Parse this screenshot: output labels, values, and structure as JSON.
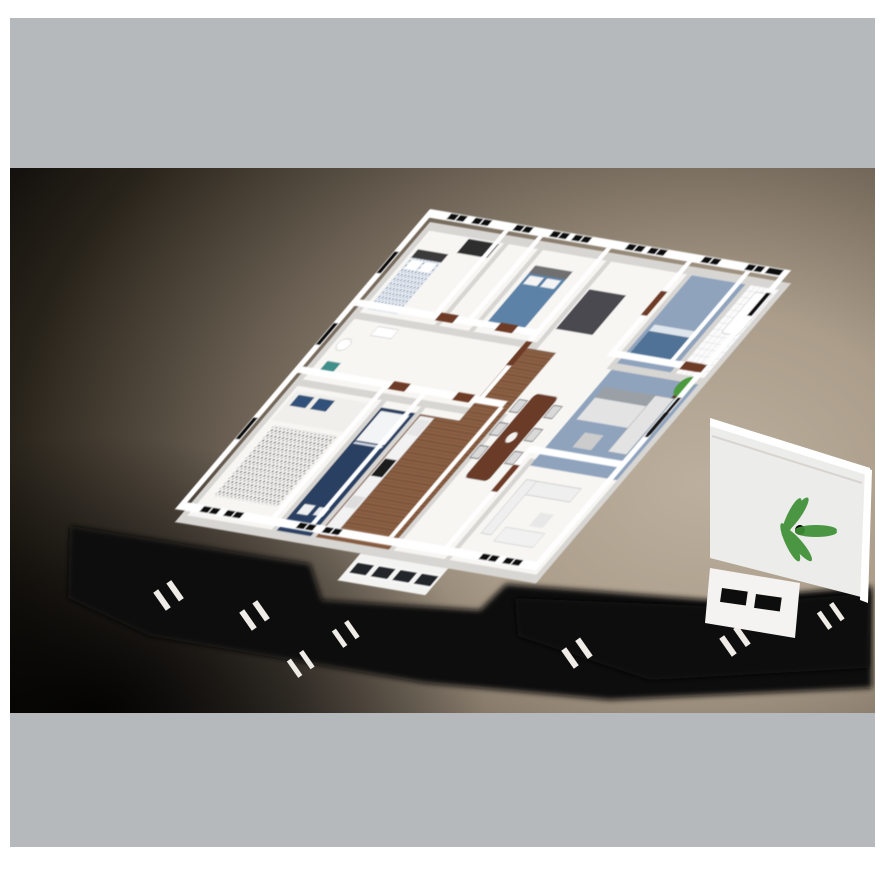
{
  "page": {
    "background": "#ffffff"
  },
  "bands": {
    "top": {
      "color": "#b6b9bc"
    },
    "bottom": {
      "color": "#b6b9bc"
    }
  },
  "render": {
    "description": "3D cutaway floor plan of a house, bird's-eye oblique view, no visible text",
    "background": {
      "highlight": "#bcaf9d",
      "mid": "#6a5f52",
      "dark": "#100d0b"
    },
    "palette": {
      "wall": "#ffffff",
      "wall_base": "#d8d6d3",
      "floor": "#f7f6f3",
      "glass": "#0d0d0d",
      "door_wood": "#6e3a26",
      "wood_floor": "#8a5f43",
      "navy_bath": "#2c3f63",
      "light_blue_floor": "#8fa3bd",
      "bed_blue": "#5b82a8",
      "sofa_gray": "#9aa0a5",
      "sofa_white": "#ededed",
      "table_brown": "#6b3b28",
      "plant_green": "#3e8f35",
      "ground_shadow": "#0a0908",
      "tile": "#fbfbfb",
      "teal_accent": "#3f8f8a",
      "rug_dark": "#4a4a50"
    },
    "rooms": [
      {
        "name": "bedroom-1",
        "floor": "#f7f6f3"
      },
      {
        "name": "hallway",
        "floor": "#8a5f43"
      },
      {
        "name": "bedroom-2",
        "floor": "#f7f6f3"
      },
      {
        "name": "family-room",
        "floor": "#8fa3bd"
      },
      {
        "name": "bathroom-tiled",
        "floor": "#fbfbfb"
      },
      {
        "name": "wc",
        "floor": "#f7f6f3"
      },
      {
        "name": "master-bedroom",
        "floor": "#f7f6f3"
      },
      {
        "name": "ensuite-bathroom",
        "floor": "#2c3f63"
      },
      {
        "name": "kitchen",
        "floor": "#8a5f43"
      },
      {
        "name": "dining-room",
        "floor": "#f7f6f3"
      },
      {
        "name": "living-room",
        "floor": "#8fa3bd"
      },
      {
        "name": "lounge",
        "floor": "#f7f6f3"
      },
      {
        "name": "terrace",
        "floor": "#ececea"
      },
      {
        "name": "porch",
        "floor": "#f3f3f1"
      }
    ],
    "furniture": [
      "patterned-double-bed",
      "blue-double-bed",
      "wardrobe",
      "dark-rug",
      "daybed",
      "bathtub",
      "shower-tray",
      "toilet",
      "sink",
      "teal-bath-mat",
      "dotted-rug",
      "master-bed",
      "kitchen-cabinets",
      "stove",
      "fridge",
      "dining-table",
      "dining-chairs",
      "gray-corner-sofa",
      "white-corner-sofa",
      "coffee-table",
      "tv-shelf",
      "potted-plant",
      "palm-plant"
    ],
    "counts": {
      "back_windows": 10,
      "left_windows": 3,
      "front_windows": 6,
      "right_windows": 2,
      "doors": 8,
      "dining_chairs": 6,
      "porch_glass_panels": 4,
      "shadow_window_slits": 7
    }
  }
}
